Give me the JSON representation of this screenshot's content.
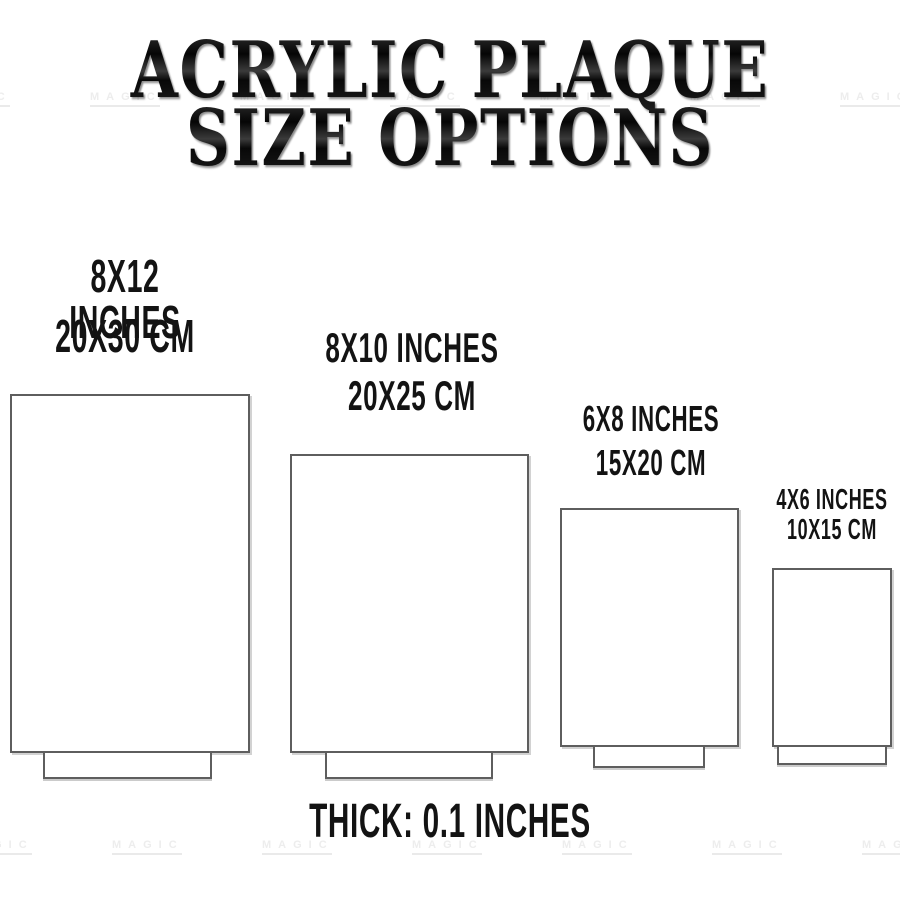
{
  "title": {
    "line1": "ACRYLIC PLAQUE",
    "line2": "SIZE OPTIONS"
  },
  "sizes": [
    {
      "inches": "8X12 INCHES",
      "cm": "20X30 CM"
    },
    {
      "inches": "8X10 INCHES",
      "cm": "20X25 CM"
    },
    {
      "inches": "6X8 INCHES",
      "cm": "15X20 CM"
    },
    {
      "inches": "4X6 INCHES",
      "cm": "10X15 CM"
    }
  ],
  "thickness_note": "THICK: 0.1 INCHES",
  "watermark_text": "MAGIC",
  "colors": {
    "outline": "#5e5e5e",
    "label_text": "#131313",
    "title_text": "#111111",
    "watermark": "#ededed",
    "background": "#ffffff"
  }
}
